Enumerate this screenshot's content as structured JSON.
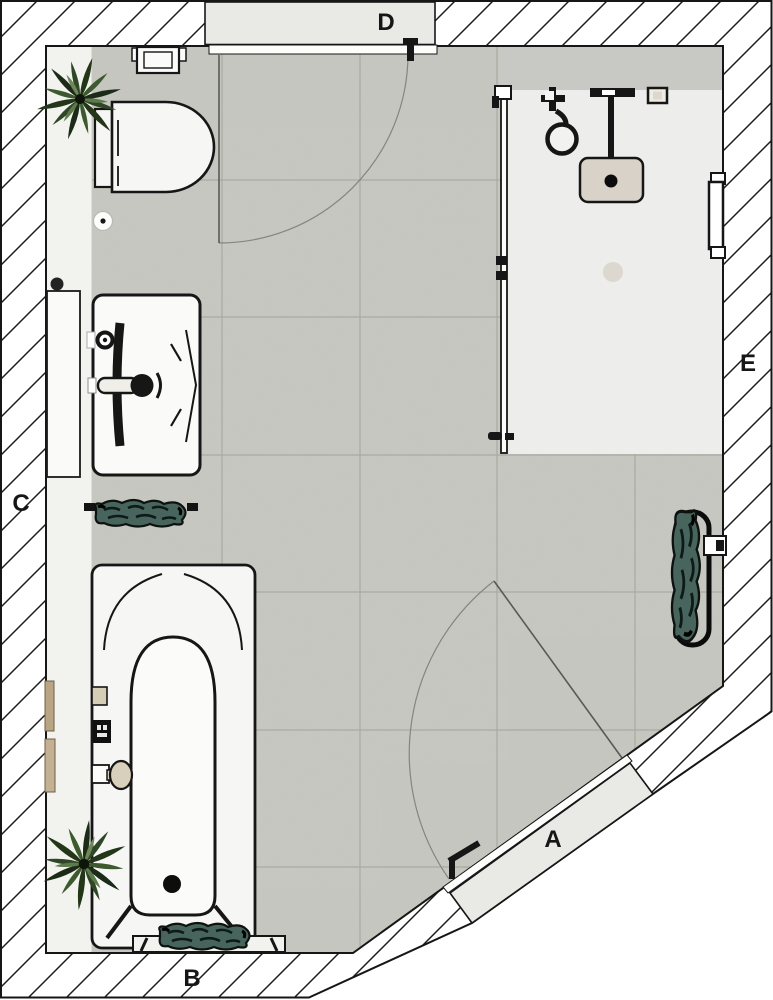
{
  "plan": {
    "wall_labels": {
      "a": "A",
      "b": "B",
      "c": "C",
      "d": "D",
      "e": "E"
    }
  },
  "fixture_icons": [
    "toilet-icon",
    "cistern-flush-plate-icon",
    "toilet-roll-holder-icon",
    "mirror-icon",
    "washbasin-icon",
    "basin-faucet-icon",
    "towel-rail-icon",
    "bathtub-icon",
    "bath-faucet-icon",
    "bath-control-icon",
    "soap-dish-icon",
    "bench-icon",
    "plant-icon",
    "shower-glass-panel-icon",
    "hand-shower-icon",
    "rain-shower-icon",
    "shower-control-icon",
    "shower-niche-icon",
    "floor-drain-icon",
    "towel-radiator-icon",
    "door-leaf-icon",
    "door-swing-icon"
  ],
  "colors": {
    "line": "#161616",
    "floor_tile": "#c7c8c1",
    "grout": "#a9aaa2",
    "shower_floor": "#ededeb",
    "shower_ledge": "#c8c8c5",
    "wall_hatch_background": "#ffffff",
    "door_panel": "#e9e9e6",
    "side_ledge": "#f2f2ef",
    "fixture_fill": "#f6f6f4",
    "shower_head": "#d9d2c8",
    "towel": "#47645d",
    "plant": "#2c4426",
    "wood": "#c0ab8f"
  }
}
